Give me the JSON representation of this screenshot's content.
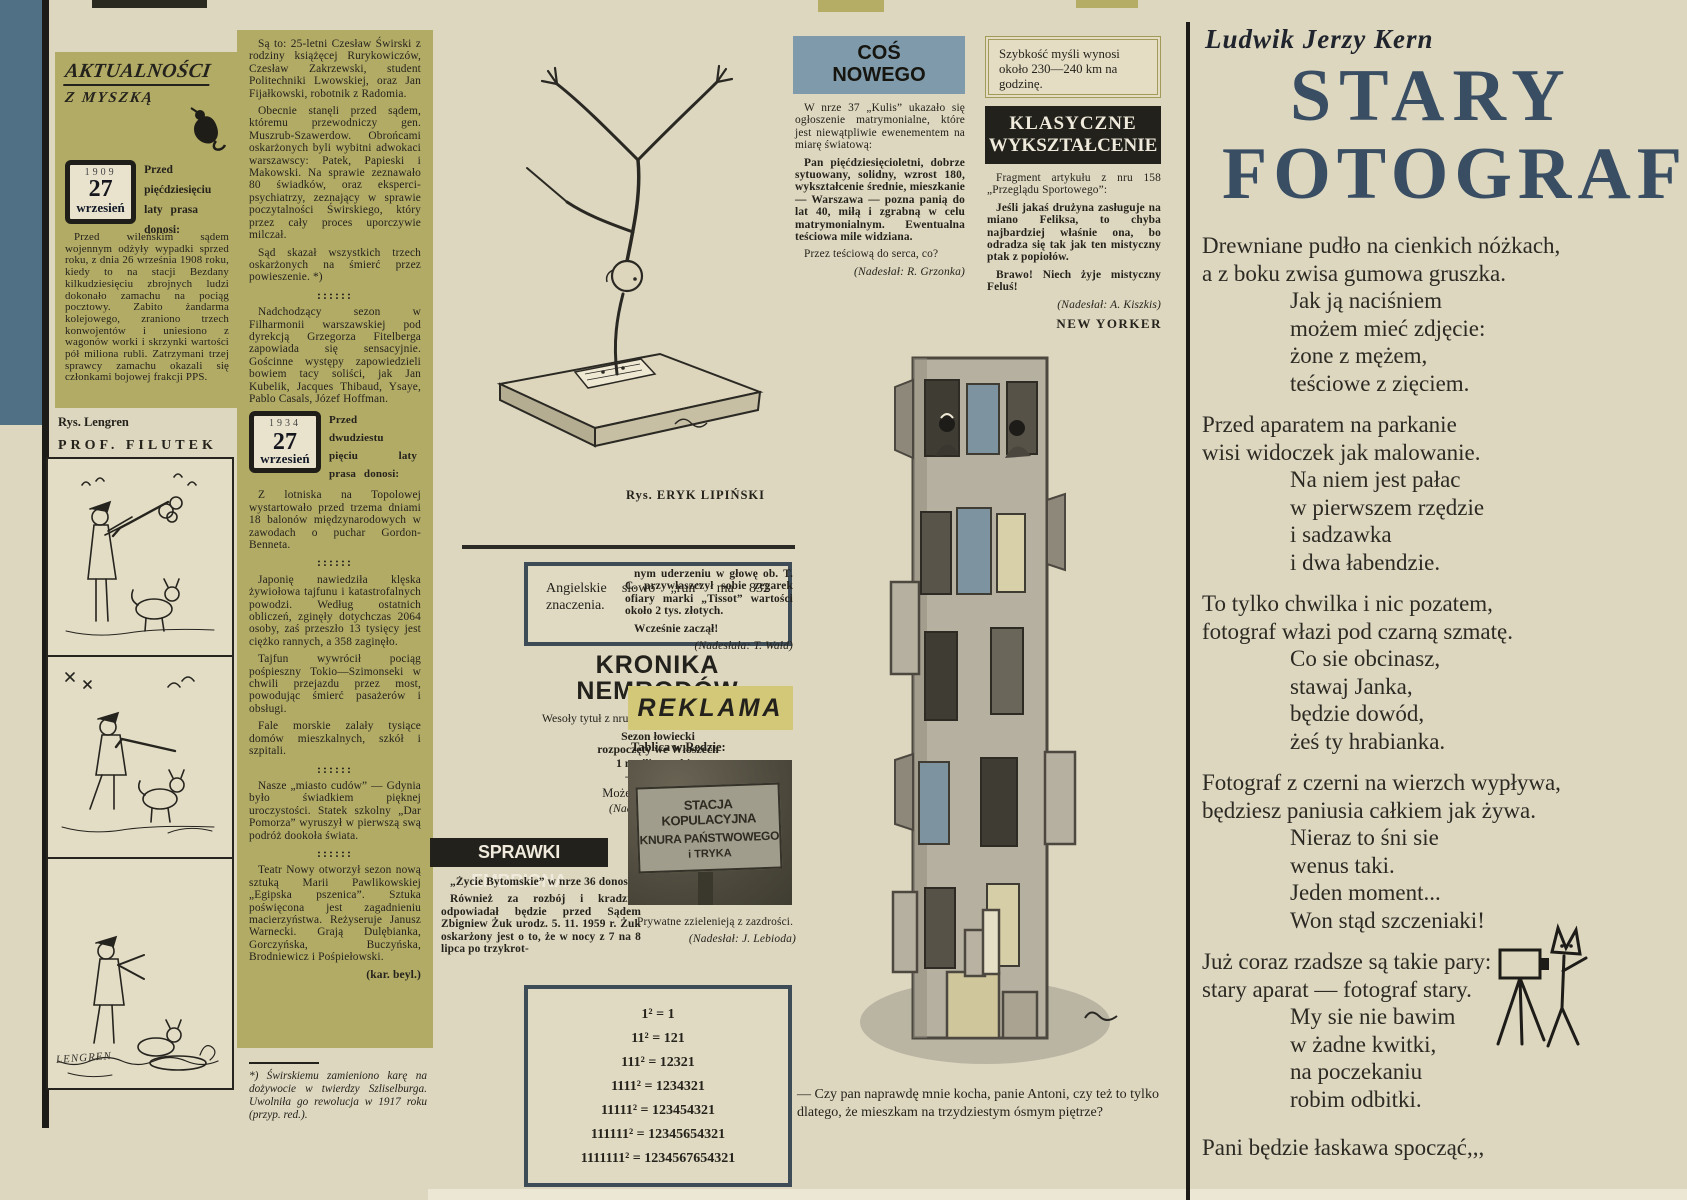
{
  "palette": {
    "paper": "#ddd7c0",
    "olive_panel": "#b2ab66",
    "steel_blue_banner": "#7f9bab",
    "edge_blue": "#507086",
    "black_banner": "#23211b",
    "reklama_yellow": "#d2c878",
    "title_blue": "#3a4e63",
    "box_border": "#3e4c57"
  },
  "misc": {
    "separator": "::::::"
  },
  "masthead": {
    "title": "AKTUALNOŚCI",
    "subtitle": "Z MYSZKĄ"
  },
  "col1909": {
    "date_year": "1909",
    "date_day": "27",
    "date_month": "wrzesień",
    "lead": "Przed pięćdziesięciu laty prasa donosi:",
    "p1": "Przed wileńskim sądem wojennym odżyły wypadki sprzed roku, z dnia 26 września 1908 roku, kiedy to na stacji Bezdany kilkudziesięciu zbrojnych ludzi dokonało zamachu na pociąg pocztowy. Zabito żandarma kolejowego, zraniono trzech konwojentów i uniesiono z wagonów worki i skrzynki wartości pół miliona rubli. Zatrzymani trzej sprawcy zamachu okazali się członkami bojowej frakcji PPS."
  },
  "col2": {
    "p1": "Są to: 25-letni Czesław Świrski z rodziny książęcej Rurykowiczów, Czesław Zakrzewski, student Politechniki Lwowskiej, oraz Jan Fijałkowski, robotnik z Radomia.",
    "p2": "Obecnie stanęli przed sądem, któremu przewodniczy gen. Muszrub-Szawerdow. Obrońcami oskarżonych byli wybitni adwokaci warszawscy: Patek, Papieski i Makowski. Na sprawie zeznawało 80 świadków, oraz eksperci-psychiatrzy, zeznający w sprawie poczytalności Świrskiego, który przez cały proces uporczywie milczał.",
    "p3": "Sąd skazał wszystkich trzech oskarżonych na śmierć przez powieszenie. *)",
    "p4": "Nadchodzący sezon w Filharmonii warszawskiej pod dyrekcją Grzegorza Fitelberga zapowiada się sensacyjnie. Gościnne występy zapowiedzieli bowiem tacy soliści, jak Jan Kubelik, Jacques Thibaud, Ysaye, Pablo Casals, Józef Hoffman.",
    "date_year": "1934",
    "date_day": "27",
    "date_month": "wrzesień",
    "lead2": "Przed dwudziestu pięciu laty prasa donosi:",
    "p5": "Z lotniska na Topolowej wystartowało przed trzema dniami 18 balonów międzynarodowych w zawodach o puchar Gordon-Benneta.",
    "p6": "Japonię nawiedziła klęska żywiołowa tajfunu i katastrofalnych powodzi. Według ostatnich obliczeń, zginęły dotychczas 2064 osoby, zaś przeszło 13 tysięcy jest ciężko rannych, a 358 zaginęło.",
    "p7": "Tajfun wywrócił pociąg pośpieszny Tokio—Szimonseki w chwili przejazdu przez most, powodując śmierć pasażerów i obsługi.",
    "p8": "Fale morskie zalały tysiące domów mieszkalnych, szkół i szpitali.",
    "p9": "Nasze „miasto cudów” — Gdynia było świadkiem pięknej uroczystości. Statek szkolny „Dar Pomorza” wyruszył w pierwszą swą podróż dookoła świata.",
    "p10": "Teatr Nowy otworzył sezon nową sztuką Marii Pawlikowskiej „Egipska pszenica”. Sztuka poświęcona jest zagadnieniu macierzyństwa. Reżyseruje Janusz Warnecki. Grają Dulębianka, Gorczyńska, Buczyńska, Brodniewicz i Pośpiełowski.",
    "sig": "(kar. beyl.)",
    "footnote": "*) Świrskiemu zamieniono karę na dożywocie w twierdzy Szliselburga. Uwolniła go rewolucja w 1917 roku (przyp. red.)."
  },
  "filutek": {
    "credit": "Rys. Lengren",
    "title": "PROF. FILUTEK",
    "signature": "LENGREN"
  },
  "lipinski": {
    "credit": "Rys. ERYK LIPIŃSKI"
  },
  "run_box": {
    "text": "Angielskie słowo „run” ma 832 znaczenia."
  },
  "kronika": {
    "title_l1": "KRONIKA",
    "title_l2": "NEMRODÓW",
    "intro": "Wesoły tytuł z nru 215 „Expressu Wieczornego”:",
    "q1": "Sezon łowiecki",
    "q2": "rozpoczęty we Włoszech",
    "q3": "1 myśliwy zabity",
    "q4": "— 9 rannych",
    "punch": "Może to byli rogacze?",
    "sig": "(Nadesłał: J. Madej)"
  },
  "sprawki": {
    "title": "SPRAWKI EMBRIONA",
    "intro": "„Życie Bytomskie” w nrze 36 donosi:",
    "body1": "Również za rozbój i kradzież odpowiadał będzie przed Sądem Zbigniew Żuk urodz. 5. 11. 1959 r. Żuk oskarżony jest o to, że w nocy z 7 na 8 lipca po trzykrot-",
    "body2": "nym uderzeniu w głowę ob. T. C. przywłaszczył sobie zegarek ofiary marki „Tissot” wartości około 2 tys. złotych.",
    "punch": "Wcześnie zaczął!",
    "sig": "(Nadesłała: T. Wald)"
  },
  "reklama": {
    "title": "REKLAMA",
    "intro": "Tablica w Redzie:",
    "sign_l1": "STACJA KOPULACYJNA",
    "sign_l2": "KNURA PAŃSTWOWEGO",
    "sign_l3": "i TRYKA",
    "punch": "Prywatne zzielenieją z zazdrości.",
    "sig": "(Nadesłał: J. Lebioda)"
  },
  "math_box": {
    "lines": [
      "1² = 1",
      "11² = 121",
      "111² = 12321",
      "1111² = 1234321",
      "11111² = 123454321",
      "111111² = 12345654321",
      "1111111² = 1234567654321"
    ]
  },
  "cos_nowego": {
    "title_l1": "COŚ",
    "title_l2": "NOWEGO",
    "p1": "W nrze 37 „Kulis” ukazało się ogłoszenie matrymonialne, które jest niewątpliwie ewenementem na miarę światową:",
    "p2": "Pan pięćdziesięcioletni, dobrze sytuowany, solidny, wzrost 180, wykształcenie średnie, mieszkanie — Warszawa — pozna panią do lat 40, miłą i zgrabną w celu matrymonialnym. Ewentualna teściowa mile widziana.",
    "p3": "Przez teściową do serca, co?",
    "sig": "(Nadesłał: R. Grzonka)"
  },
  "szybkosc": {
    "text": "Szybkość myśli wynosi około 230—240 km na godzinę."
  },
  "klasyczne": {
    "title_l1": "KLASYCZNE",
    "title_l2": "WYKSZTAŁCENIE",
    "p1": "Fragment artykułu z nru 158 „Przeglądu Sportowego”:",
    "p2": "Jeśli jakaś drużyna zasługuje na miano Feliksa, to chyba najbardziej właśnie ona, bo odradza się tak jak ten mistyczny ptak z popiołów.",
    "p3": "Brawo! Niech żyje mistyczny Feluś!",
    "sig": "(Nadesłał: A. Kiszkis)"
  },
  "new_yorker": {
    "label": "NEW YORKER",
    "caption": "— Czy pan naprawdę mnie kocha, panie Antoni, czy też to tylko dlatego, że mieszkam na trzydziestym ósmym piętrze?"
  },
  "poem": {
    "author": "Ludwik Jerzy Kern",
    "title_l1": "STARY",
    "title_l2": "FOTOGRAF",
    "stanzas": [
      [
        "Drewniane pudło na cienkich nóżkach,",
        "a z boku zwisa gumowa gruszka.",
        "Jak ją naciśniem",
        "możem mieć zdjęcie:",
        "żone z mężem,",
        "teściowe z zięciem."
      ],
      [
        "Przed aparatem na parkanie",
        "wisi widoczek jak malowanie.",
        "Na niem jest pałac",
        "w pierwszem rzędzie",
        "i sadzawka",
        "i dwa łabendzie."
      ],
      [
        "To tylko chwilka i nic pozatem,",
        "fotograf włazi pod czarną szmatę.",
        "Co sie obcinasz,",
        "stawaj Janka,",
        "będzie dowód,",
        "żeś ty hrabianka."
      ],
      [
        "Fotograf z czerni na wierzch wypływa,",
        "będziesz paniusia całkiem jak żywa.",
        "Nieraz to śni sie",
        "wenus taki.",
        "Jeden moment...",
        "Won stąd szczeniaki!"
      ],
      [
        "Już coraz rzadsze są takie pary:",
        "stary aparat — fotograf stary.",
        "My sie nie bawim",
        "w żadne kwitki,",
        "na poczekaniu",
        "robim odbitki."
      ]
    ],
    "closing": "Pani będzie łaskawa spocząć,,,"
  }
}
